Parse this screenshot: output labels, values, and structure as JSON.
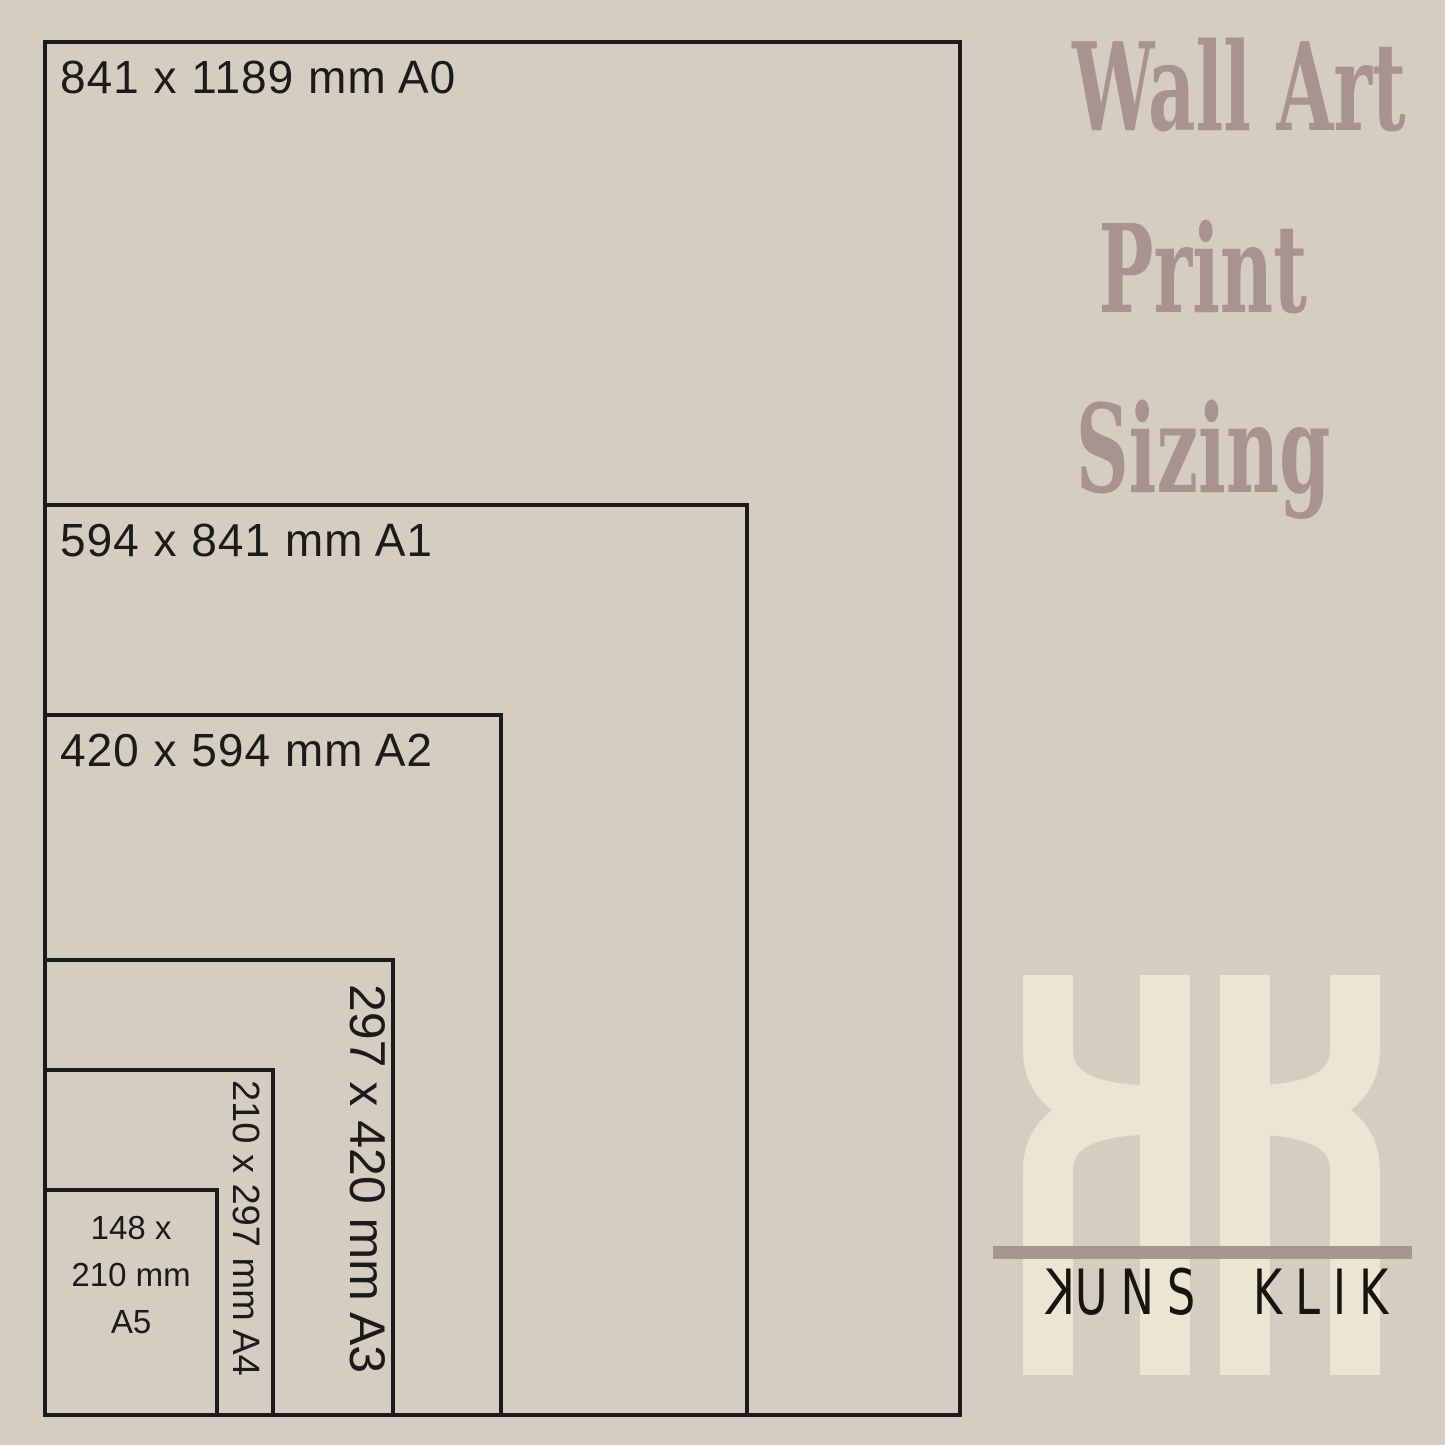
{
  "canvas": {
    "background_color": "#d6cdc2",
    "line_color": "#1b1b1b"
  },
  "title": {
    "color": "#a8938e",
    "lines": [
      "Wall Art",
      "Print",
      "Sizing"
    ]
  },
  "sizes": [
    {
      "format": "A0",
      "label": "841 x 1189 mm A0",
      "width_mm": 841,
      "height_mm": 1189
    },
    {
      "format": "A1",
      "label": "594 x 841 mm A1",
      "width_mm": 594,
      "height_mm": 841
    },
    {
      "format": "A2",
      "label": "420 x 594 mm A2",
      "width_mm": 420,
      "height_mm": 594
    },
    {
      "format": "A3",
      "label": "297 x 420 mm A3",
      "width_mm": 297,
      "height_mm": 420
    },
    {
      "format": "A4",
      "label": "210 x 297 mm A4",
      "width_mm": 210,
      "height_mm": 297
    },
    {
      "format": "A5",
      "label": "148 x 210 mm A5",
      "label_lines": [
        "148 x",
        "210 mm",
        "A5"
      ],
      "width_mm": 148,
      "height_mm": 210
    }
  ],
  "logo": {
    "monogram": "KK",
    "monogram_color": "#ede5d4",
    "divider_color": "#a59690",
    "wordmark_color": "#16160f",
    "word_first_initial": "K",
    "word_first_rest": "UNS",
    "word_second": "KLIK"
  }
}
